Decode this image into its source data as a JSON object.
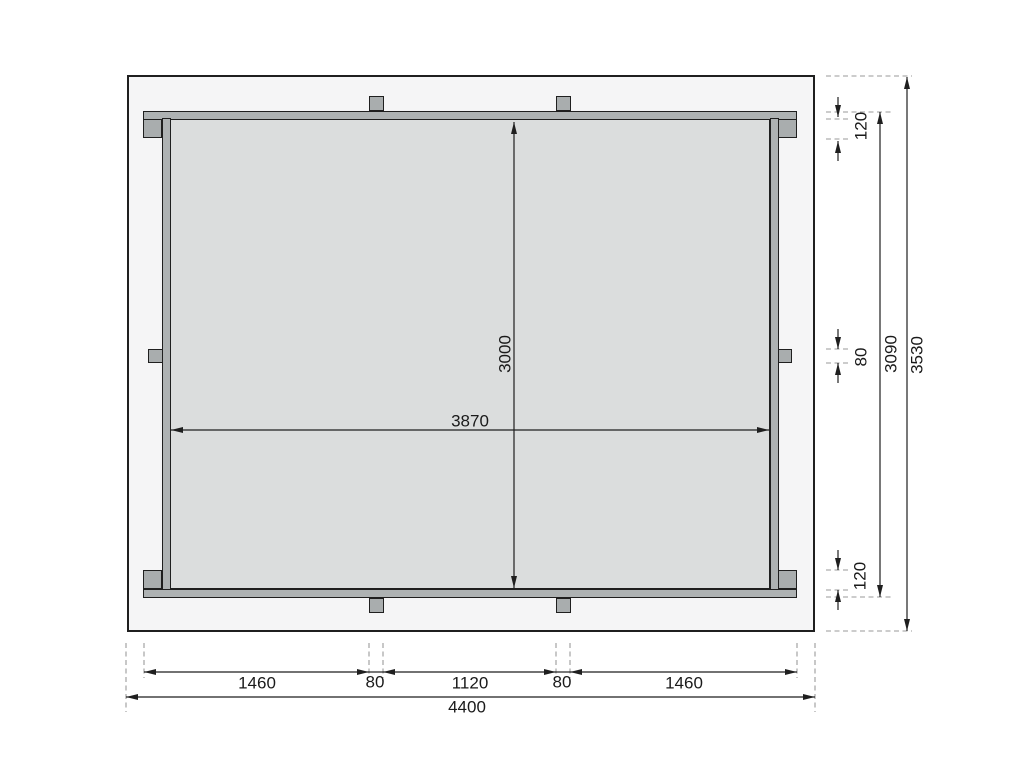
{
  "drawing": {
    "kind": "floor-frame-plan",
    "dims": {
      "inner_depth": "3000",
      "inner_width": "3870",
      "right_chain": {
        "top": "120",
        "mid": "80",
        "bottom": "120"
      },
      "frame_depth": "3090",
      "overall_depth": "3530",
      "bottom_chain": [
        "1460",
        "80",
        "1120",
        "80",
        "1460"
      ],
      "overall_width": "4400"
    },
    "colors": {
      "bg": "#ffffff",
      "roof_fill": "#f5f5f6",
      "beam_fill": "#aeb2b3",
      "post_fill": "#a9adae",
      "floor_fill": "#dbdddd",
      "line": "#1f1f1f",
      "dash": "#9a9a9a",
      "text": "#1a1a1a"
    }
  }
}
